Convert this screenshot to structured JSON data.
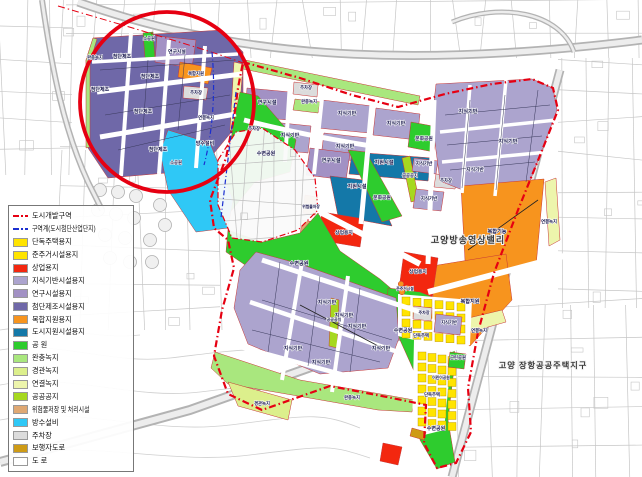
{
  "legend": {
    "items": [
      {
        "type": "line",
        "color": "#E60012",
        "label": "도시개발구역"
      },
      {
        "type": "line",
        "color": "#1B2FD0",
        "label": "구역계(도시첨단산업단지)"
      },
      {
        "type": "swatch",
        "key": "house",
        "label": "단독주택용지"
      },
      {
        "type": "swatch",
        "key": "house",
        "label": "준주거시설용지"
      },
      {
        "type": "swatch",
        "key": "commercial",
        "label": "상업용지"
      },
      {
        "type": "swatch",
        "key": "knowledge",
        "label": "지식기반시설용지"
      },
      {
        "type": "swatch",
        "key": "research",
        "label": "연구시설용지"
      },
      {
        "type": "swatch",
        "key": "adv_mfg",
        "label": "첨단제조시설용지"
      },
      {
        "type": "swatch",
        "key": "mixed",
        "label": "복합지원용지"
      },
      {
        "type": "swatch",
        "key": "city_support",
        "label": "도시지원시설용지"
      },
      {
        "type": "swatch",
        "key": "park",
        "label": "공 원"
      },
      {
        "type": "swatch",
        "key": "buffer_green",
        "label": "완충녹지"
      },
      {
        "type": "swatch",
        "key": "scenic_green",
        "label": "경관녹지"
      },
      {
        "type": "swatch",
        "key": "link_green",
        "label": "연결녹지"
      },
      {
        "type": "swatch",
        "key": "public_open",
        "label": "공공공지"
      },
      {
        "type": "swatch",
        "key": "hazmat",
        "label": "위험물저장 및 처리시설"
      },
      {
        "type": "swatch",
        "key": "flood",
        "label": "방수설비"
      },
      {
        "type": "swatch",
        "key": "parking",
        "label": "주차장"
      },
      {
        "type": "swatch",
        "key": "pedestrian",
        "label": "보행자도로"
      },
      {
        "type": "swatch",
        "key": "road",
        "label": "도 로"
      }
    ]
  },
  "colors": {
    "house": "#FFE400",
    "commercial": "#F3270F",
    "knowledge": "#ACA4CE",
    "research": "#A291C4",
    "adv_mfg": "#6F68A8",
    "mixed": "#F7941E",
    "city_support": "#1478A8",
    "park": "#2ECC2E",
    "buffer_green": "#A9E77E",
    "scenic_green": "#DCEF8C",
    "link_green": "#EDF5AC",
    "public_open": "#A6D81F",
    "hazmat": "#DFA873",
    "flood": "#2FC8F6",
    "parking": "#DCDCDC",
    "pedestrian": "#CE9B16",
    "road": "#FFFFFF",
    "boundary_red": "#E60012",
    "boundary_blue": "#1B2FD0",
    "cadastral": "#c6c6c6",
    "highway": "#b3b3b3"
  },
  "districts": [
    {
      "text": "고양방송영상밸리",
      "x": 468,
      "y": 243,
      "s": 9
    },
    {
      "text": "고양 장항공공주택지구",
      "x": 543,
      "y": 368,
      "s": 8.2
    }
  ],
  "parcel_labels": [
    {
      "t": "첨단제조",
      "x": 122,
      "y": 58,
      "s": 5
    },
    {
      "t": "첨단제조",
      "x": 100,
      "y": 91,
      "s": 5
    },
    {
      "t": "첨단제조",
      "x": 150,
      "y": 78,
      "s": 5
    },
    {
      "t": "첨단제조",
      "x": 143,
      "y": 113,
      "s": 5
    },
    {
      "t": "첨단제조",
      "x": 158,
      "y": 151,
      "s": 5
    },
    {
      "t": "소공원",
      "x": 149,
      "y": 40,
      "s": 4.3
    },
    {
      "t": "연구시설",
      "x": 177,
      "y": 53,
      "s": 4.8
    },
    {
      "t": "복합지원",
      "x": 196,
      "y": 75,
      "s": 4.3
    },
    {
      "t": "주차장",
      "x": 196,
      "y": 94,
      "s": 4.3
    },
    {
      "t": "연결녹지",
      "x": 206,
      "y": 119,
      "s": 4.3
    },
    {
      "t": "소공원",
      "x": 176,
      "y": 164,
      "s": 4.3
    },
    {
      "t": "완충녹지",
      "x": 95,
      "y": 59,
      "s": 4.3
    },
    {
      "t": "방수설비",
      "x": 205,
      "y": 145,
      "s": 5
    },
    {
      "t": "연구시설",
      "x": 267,
      "y": 104,
      "s": 5.2
    },
    {
      "t": "주차장",
      "x": 306,
      "y": 89,
      "s": 4.3
    },
    {
      "t": "완충녹지",
      "x": 309,
      "y": 103,
      "s": 4.3
    },
    {
      "t": "지식기반",
      "x": 347,
      "y": 115,
      "s": 5
    },
    {
      "t": "지식기반",
      "x": 396,
      "y": 125,
      "s": 5
    },
    {
      "t": "지식기반",
      "x": 290,
      "y": 137,
      "s": 5
    },
    {
      "t": "주차장",
      "x": 254,
      "y": 130,
      "s": 4.3
    },
    {
      "t": "지식기반",
      "x": 345,
      "y": 148,
      "s": 5
    },
    {
      "t": "연구시설",
      "x": 331,
      "y": 162,
      "s": 5.2
    },
    {
      "t": "수변공원",
      "x": 266,
      "y": 155,
      "s": 5
    },
    {
      "t": "문화공원",
      "x": 424,
      "y": 140,
      "s": 4.8
    },
    {
      "t": "지원시설",
      "x": 384,
      "y": 164,
      "s": 5.2
    },
    {
      "t": "지원시설",
      "x": 357,
      "y": 188,
      "s": 5.2
    },
    {
      "t": "문화공원",
      "x": 382,
      "y": 199,
      "s": 4.8
    },
    {
      "t": "공공공지",
      "x": 410,
      "y": 177,
      "s": 4.3
    },
    {
      "t": "지식기반",
      "x": 424,
      "y": 165,
      "s": 4.5
    },
    {
      "t": "주차장",
      "x": 446,
      "y": 182,
      "s": 4.3
    },
    {
      "t": "지식기반",
      "x": 429,
      "y": 200,
      "s": 4.5
    },
    {
      "t": "지식기반",
      "x": 468,
      "y": 113,
      "s": 5.2
    },
    {
      "t": "지식기반",
      "x": 508,
      "y": 143,
      "s": 5.2
    },
    {
      "t": "지식기반",
      "x": 475,
      "y": 171,
      "s": 4.8
    },
    {
      "t": "복합기능",
      "x": 497,
      "y": 233,
      "s": 5.2
    },
    {
      "t": "연결녹지",
      "x": 549,
      "y": 223,
      "s": 4.3
    },
    {
      "t": "복합지원",
      "x": 470,
      "y": 303,
      "s": 5.2
    },
    {
      "t": "연결녹지",
      "x": 479,
      "y": 332,
      "s": 4.3
    },
    {
      "t": "상업용지",
      "x": 344,
      "y": 234,
      "s": 4.8
    },
    {
      "t": "상업용지",
      "x": 418,
      "y": 273,
      "s": 4.8
    },
    {
      "t": "위험물저장",
      "x": 311,
      "y": 208,
      "s": 3.8
    },
    {
      "t": "수변공원",
      "x": 299,
      "y": 265,
      "s": 5.2
    },
    {
      "t": "지식기반",
      "x": 327,
      "y": 304,
      "s": 5
    },
    {
      "t": "지식기반",
      "x": 344,
      "y": 317,
      "s": 5
    },
    {
      "t": "지식기반",
      "x": 357,
      "y": 328,
      "s": 5
    },
    {
      "t": "지식기반",
      "x": 381,
      "y": 350,
      "s": 5
    },
    {
      "t": "지식기반",
      "x": 321,
      "y": 364,
      "s": 5
    },
    {
      "t": "지식기반",
      "x": 293,
      "y": 350,
      "s": 5
    },
    {
      "t": "공공공지",
      "x": 334,
      "y": 321,
      "s": 4
    },
    {
      "t": "경관녹지",
      "x": 262,
      "y": 405,
      "s": 4.3
    },
    {
      "t": "완충녹지",
      "x": 352,
      "y": 399,
      "s": 4.3
    },
    {
      "t": "수변공원",
      "x": 403,
      "y": 332,
      "s": 5
    },
    {
      "t": "수변공원",
      "x": 436,
      "y": 430,
      "s": 5
    },
    {
      "t": "단독주택",
      "x": 421,
      "y": 337,
      "s": 4.3
    },
    {
      "t": "지식기반",
      "x": 449,
      "y": 324,
      "s": 4.3
    },
    {
      "t": "주차장",
      "x": 424,
      "y": 314,
      "s": 4
    },
    {
      "t": "근린공원",
      "x": 458,
      "y": 359,
      "s": 4.3
    },
    {
      "t": "어린이공원",
      "x": 441,
      "y": 379,
      "s": 3.8
    },
    {
      "t": "준주거시설",
      "x": 405,
      "y": 290,
      "s": 3.8
    },
    {
      "t": "단독주택",
      "x": 432,
      "y": 396,
      "s": 4.3
    }
  ]
}
